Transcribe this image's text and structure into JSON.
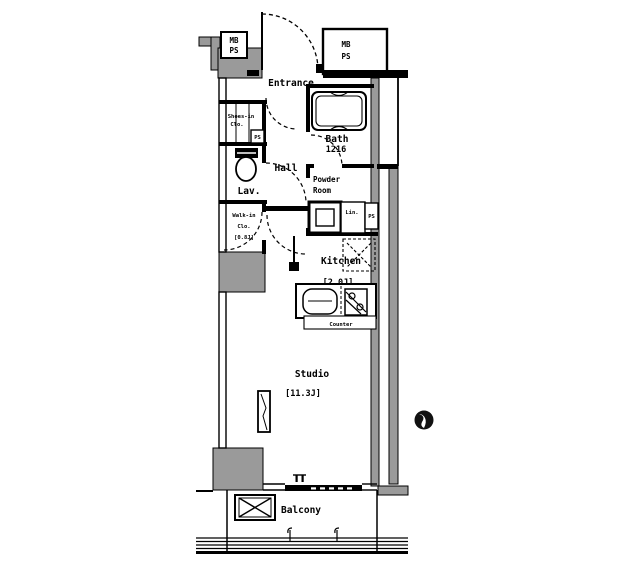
{
  "plan": {
    "colors": {
      "wall_fill": "#9a9a9a",
      "line": "#000000",
      "background": "#ffffff"
    },
    "rooms": {
      "entrance": "Entrance",
      "shoes_closet_line1": "Shoes-in",
      "shoes_closet_line2": "Clo.",
      "hall": "Hall",
      "lavatory": "Lav.",
      "bath_name": "Bath",
      "bath_size": "1216",
      "powder_line1": "Powder",
      "powder_line2": "Room",
      "linen": "Lin.",
      "walkin_line1": "Walk-in",
      "walkin_line2": "Clo.",
      "walkin_line3": "[0.8J]",
      "kitchen_name": "Kitchen",
      "kitchen_size": "[2.0J]",
      "counter": "Counter",
      "studio_name": "Studio",
      "studio_size": "[11.3J]",
      "balcony": "Balcony"
    },
    "utility": {
      "meter_box_left_line1": "MB",
      "meter_box_left_line2": "PS",
      "meter_box_right_line1": "MB",
      "meter_box_right_line2": "PS",
      "pipe_shaft_small_shoes": "PS",
      "pipe_shaft_small_linen": "PS"
    }
  }
}
